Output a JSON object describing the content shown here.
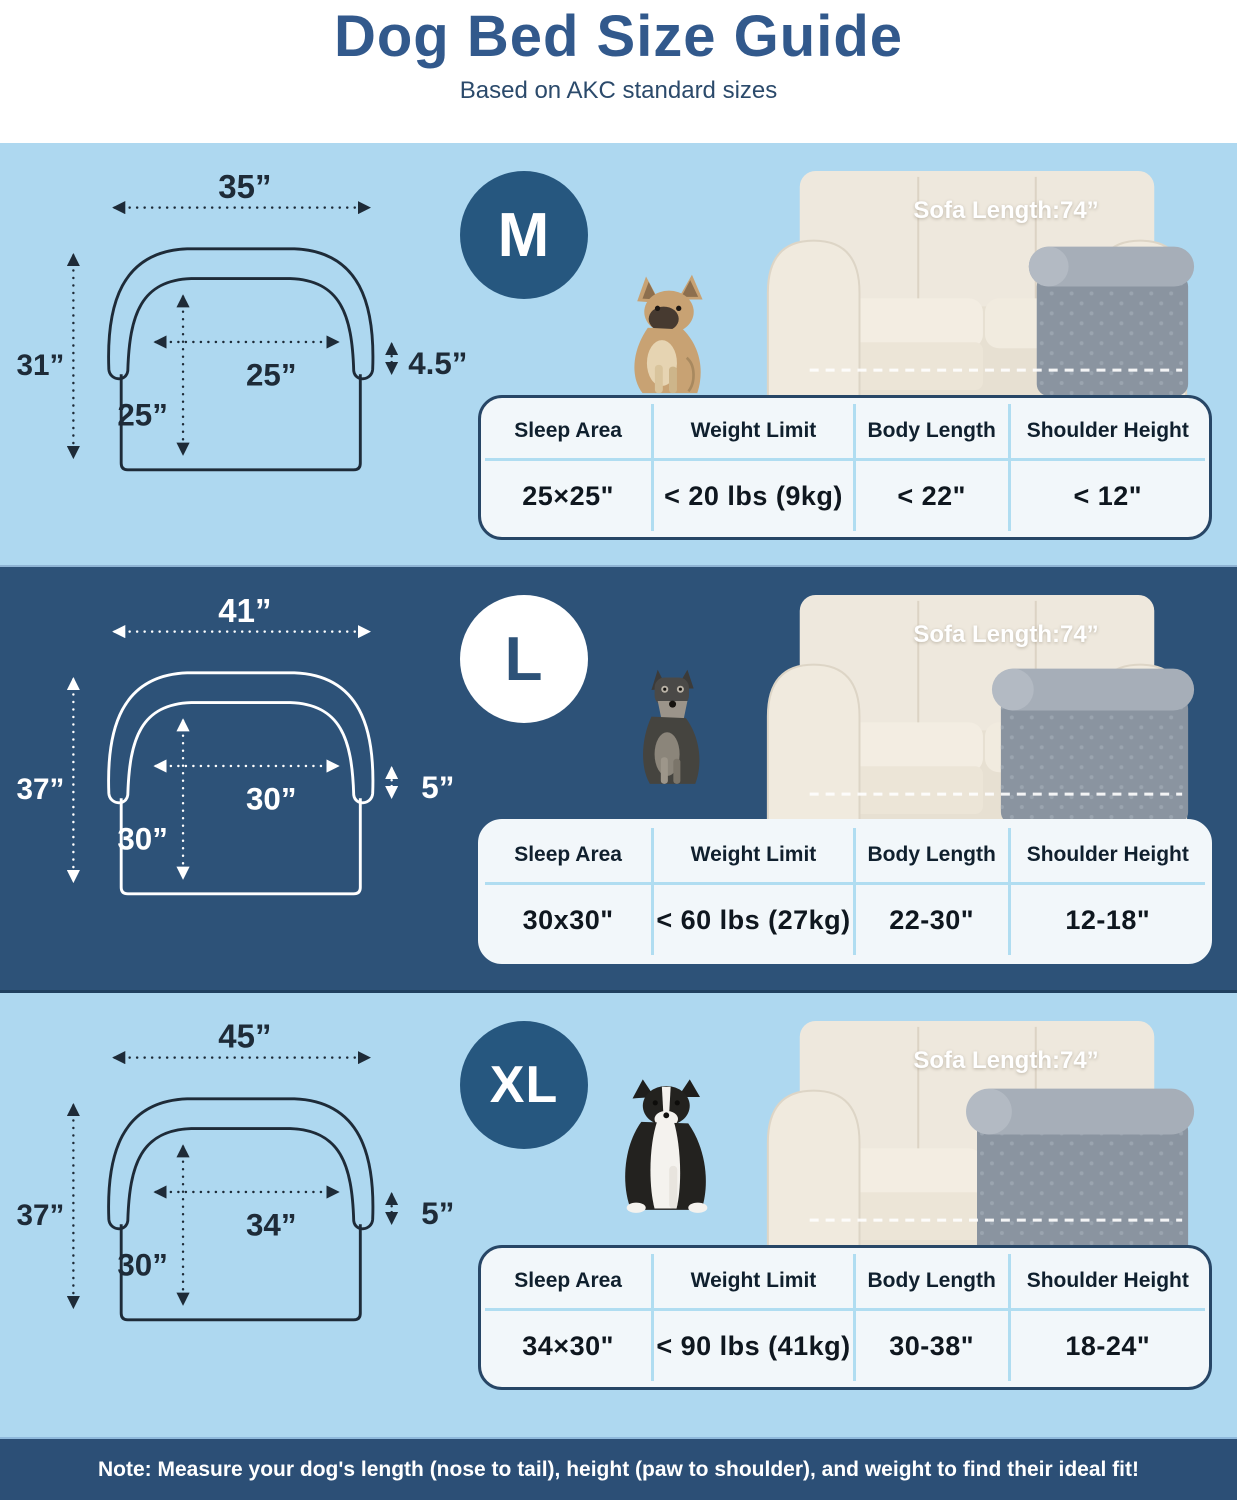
{
  "header": {
    "title": "Dog Bed Size Guide",
    "subtitle": "Based on AKC standard sizes"
  },
  "table_headers": [
    "Sleep Area",
    "Weight Limit",
    "Body Length",
    "Shoulder Height"
  ],
  "sections": [
    {
      "badge": "M",
      "theme": "light",
      "dog_breed": "french-bulldog",
      "sofa_label": "Sofa Length:74”",
      "dimensions": {
        "width": "35”",
        "height": "31”",
        "inner_width": "25”",
        "inner_depth": "25”",
        "side_height": "4.5”"
      },
      "table": {
        "sleep_area": "25×25\"",
        "weight_limit": "< 20 lbs (9kg)",
        "body_length": "< 22\"",
        "shoulder_height": "< 12\""
      }
    },
    {
      "badge": "L",
      "theme": "dark",
      "dog_breed": "schnauzer",
      "sofa_label": "Sofa Length:74”",
      "dimensions": {
        "width": "41”",
        "height": "37”",
        "inner_width": "30”",
        "inner_depth": "30”",
        "side_height": "5”"
      },
      "table": {
        "sleep_area": "30x30\"",
        "weight_limit": "< 60 lbs (27kg)",
        "body_length": "22-30\"",
        "shoulder_height": "12-18\""
      }
    },
    {
      "badge": "XL",
      "theme": "light",
      "dog_breed": "border-collie",
      "sofa_label": "Sofa Length:74”",
      "dimensions": {
        "width": "45”",
        "height": "37”",
        "inner_width": "34”",
        "inner_depth": "30”",
        "side_height": "5”"
      },
      "table": {
        "sleep_area": "34×30\"",
        "weight_limit": "< 90 lbs (41kg)",
        "body_length": "30-38\"",
        "shoulder_height": "18-24\""
      }
    }
  ],
  "note": "Note: Measure your dog's length (nose to tail), height (paw to shoulder), and weight to find their ideal fit!",
  "colors": {
    "title": "#32598c",
    "subtitle": "#2b4a6b",
    "light_section_bg": "#aed8f0",
    "dark_section_bg": "#2d5278",
    "badge_dark": "#26577f",
    "table_bg": "#f2f7fa",
    "table_border": "#274666",
    "table_divider": "#b0ddf1",
    "note_bar_bg": "#2c4f76",
    "bed_gray": "#8a94a0",
    "sofa_cream": "#eee8dd"
  }
}
